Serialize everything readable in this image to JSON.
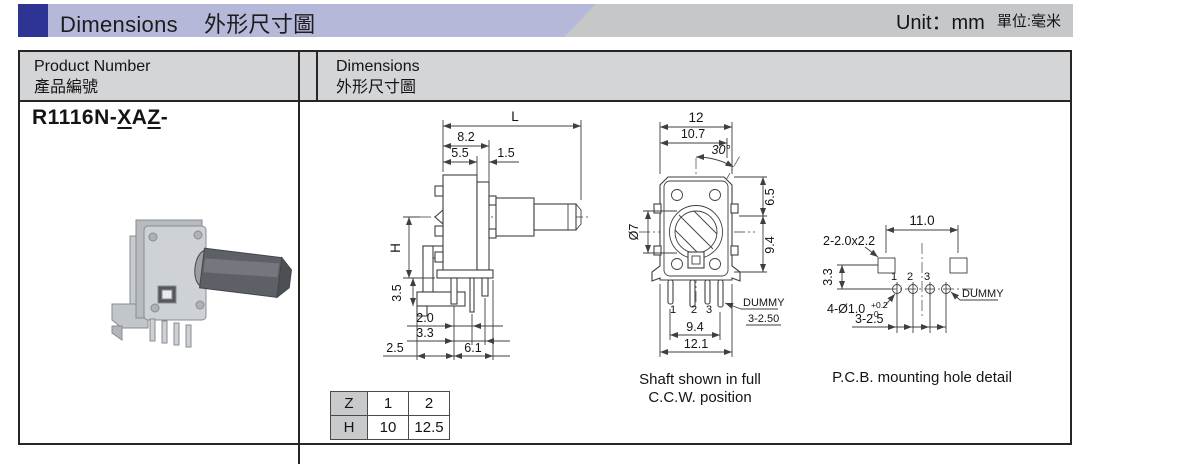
{
  "header": {
    "title_en": "Dimensions",
    "title_zh": "外形尺寸圖",
    "unit_en": "Unit：mm",
    "unit_zh": "單位:毫米",
    "accent_color": "#2d3494"
  },
  "table": {
    "col1_header_en": "Product Number",
    "col1_header_zh": "產品編號",
    "col2_header_en": "Dimensions",
    "col2_header_zh": "外形尺寸圖",
    "product_number": {
      "seg1": "R1116N-",
      "seg2": "X",
      "seg3": "A",
      "seg4": "Z",
      "seg5": "-"
    }
  },
  "side_view": {
    "dims": {
      "L": "L",
      "d82": "8.2",
      "d55": "5.5",
      "d15": "1.5",
      "H": "H",
      "d35": "3.5",
      "d20": "2.0",
      "d33": "3.3",
      "d25": "2.5",
      "d61": "6.1"
    }
  },
  "zh_table": {
    "rows": [
      [
        "Z",
        "1",
        "2"
      ],
      [
        "H",
        "10",
        "12.5"
      ]
    ]
  },
  "front_view": {
    "dims": {
      "d12": "12",
      "d107": "10.7",
      "angle": "30°",
      "dia": "Ø7",
      "d65": "6.5",
      "d94_side": "9.4",
      "d94_bottom": "9.4",
      "d121": "12.1",
      "pins": [
        "1",
        "2",
        "3"
      ],
      "dummy": "DUMMY",
      "d3250": "3-2.50"
    },
    "caption_line1": "Shaft shown in full",
    "caption_line2": "C.C.W. position"
  },
  "pcb_view": {
    "dims": {
      "d110": "11.0",
      "slots": "2-2.0x2.2",
      "d33": "3.3",
      "holes": "4-Ø1.0",
      "tol_plus": "+0.2",
      "tol_minus": "-0",
      "d325": "3-2.5",
      "dummy": "DUMMY",
      "pins": [
        "1",
        "2",
        "3"
      ]
    },
    "caption": "P.C.B.  mounting hole detail"
  }
}
